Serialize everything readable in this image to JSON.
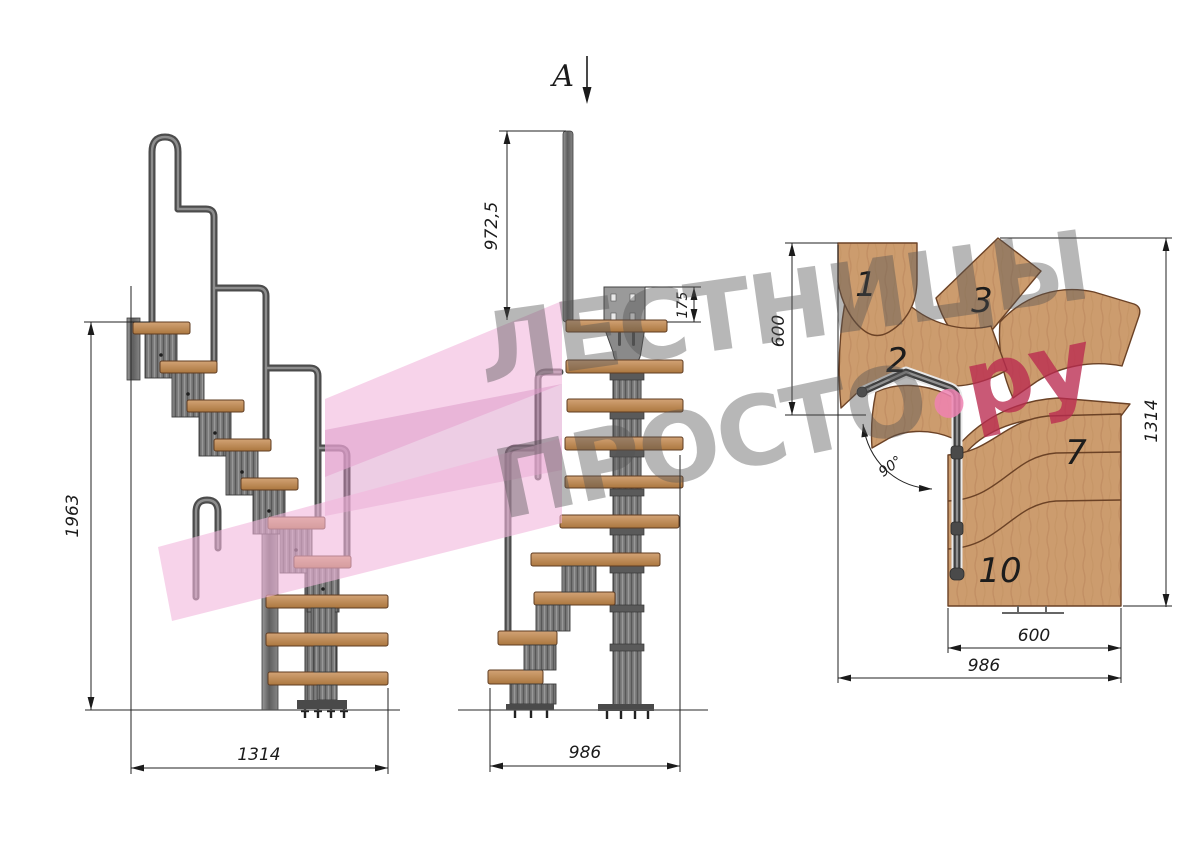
{
  "title": "Modular staircase technical drawing with 90 degree turn",
  "section_marker": {
    "label": "A"
  },
  "side_view": {
    "height_label": "1963",
    "length_label": "1314"
  },
  "front_view": {
    "rail_height_label": "972,5",
    "plate_offset_label": "175",
    "width_label": "986"
  },
  "plan_view": {
    "entry_width_label": "600",
    "overall_depth_label": "1314",
    "step_width_label": "600",
    "overall_width_label": "986",
    "turn_angle_label": "90°",
    "steps": {
      "n1": "1",
      "n2": "2",
      "n3": "3",
      "n7": "7",
      "n10": "10"
    }
  },
  "watermark": {
    "line1": "ЛЕСТНИЦЫ",
    "line2": "ПРОСТО",
    "suffix": "ру",
    "gray_color": "#545454",
    "pink_text_color": "#ba2a50",
    "dot_color": "#ef83b1",
    "overlay_pink_color": "#f2b6dc"
  },
  "colors": {
    "wood": "#cc9c6e",
    "wood_dark": "#b27c49",
    "wood_outline": "#6b4226",
    "metal": "#7b7b7b",
    "metal_dark": "#3d3d3d",
    "dim_line": "#222222",
    "background": "#ffffff"
  }
}
